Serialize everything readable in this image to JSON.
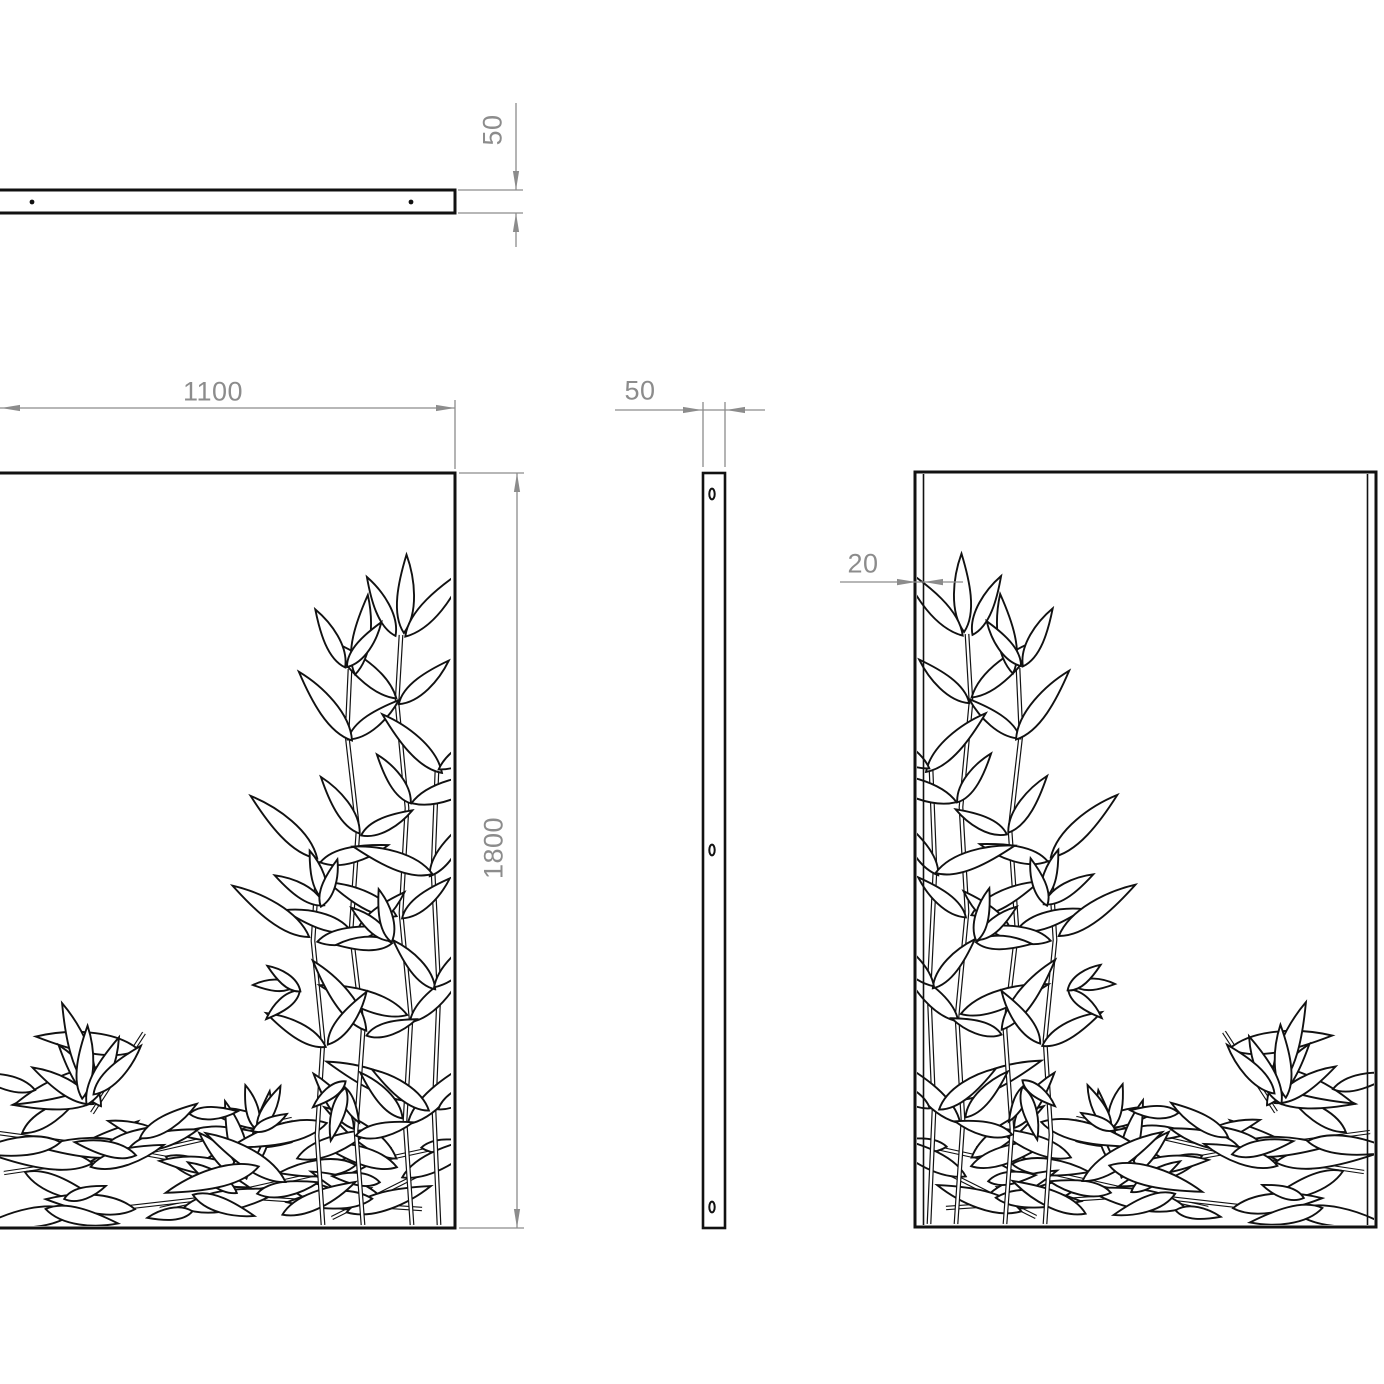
{
  "dimensions": {
    "top_thickness": "50",
    "panel_width": "1100",
    "panel_height": "1800",
    "side_depth": "50",
    "flange_depth": "20"
  },
  "colors": {
    "geometry": "#111111",
    "dimension": "#8c8c8c",
    "background": "#ffffff"
  }
}
